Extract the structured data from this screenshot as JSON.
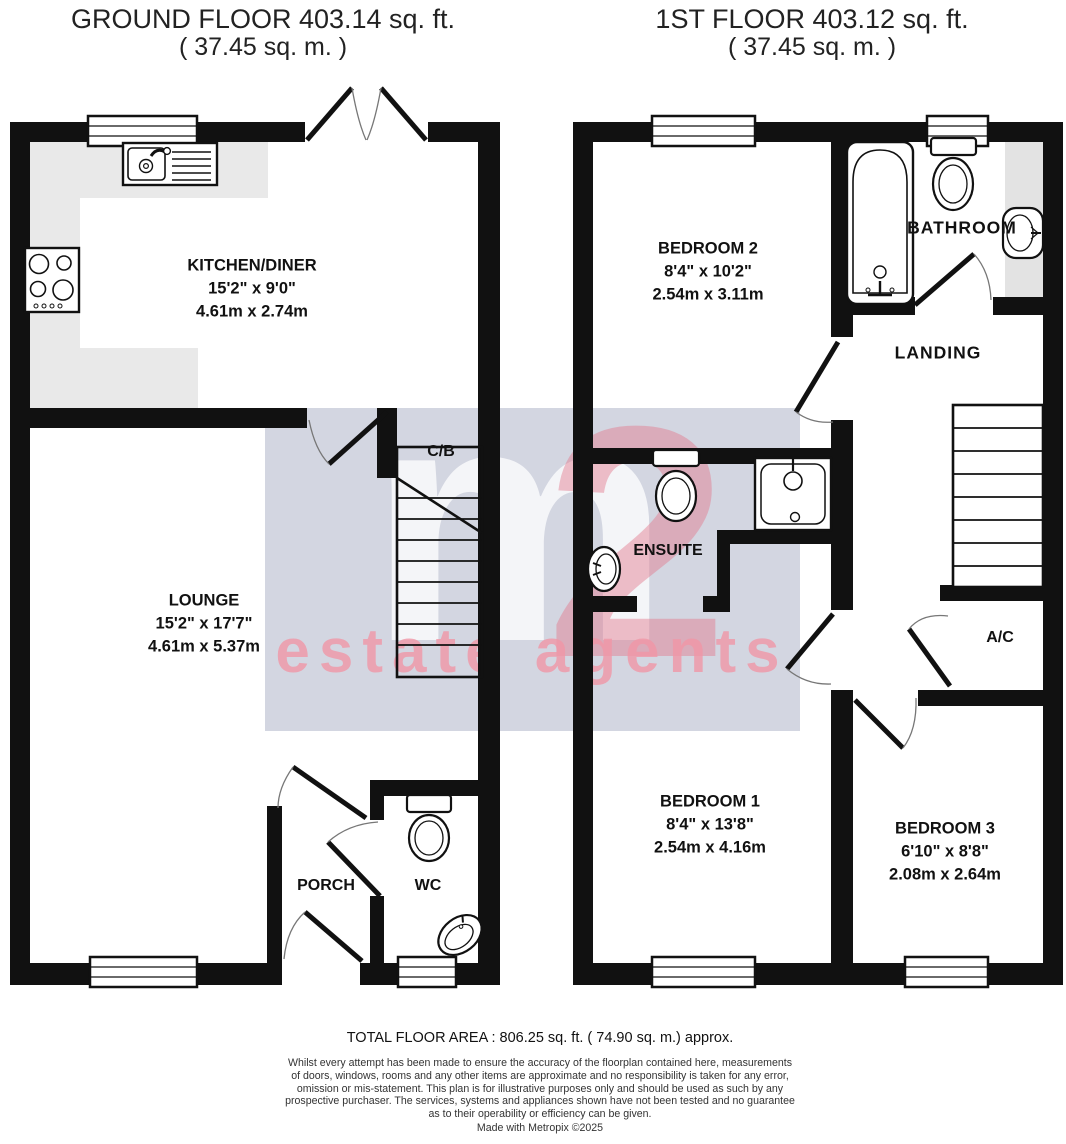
{
  "ground_floor": {
    "title": "GROUND FLOOR 403.14 sq. ft.",
    "subtitle": "( 37.45 sq. m. )",
    "rooms": {
      "kitchen": {
        "name": "KITCHEN/DINER",
        "imperial": "15'2\" x 9'0\"",
        "metric": "4.61m x 2.74m"
      },
      "lounge": {
        "name": "LOUNGE",
        "imperial": "15'2\" x 17'7\"",
        "metric": "4.61m x 5.37m"
      },
      "cb": {
        "name": "C/B"
      },
      "porch": {
        "name": "PORCH"
      },
      "wc": {
        "name": "WC"
      }
    }
  },
  "first_floor": {
    "title": "1ST FLOOR 403.12 sq. ft.",
    "subtitle": "( 37.45 sq. m. )",
    "rooms": {
      "bedroom2": {
        "name": "BEDROOM 2",
        "imperial": "8'4\" x 10'2\"",
        "metric": "2.54m x 3.11m"
      },
      "bathroom": {
        "name": "BATHROOM"
      },
      "landing": {
        "name": "LANDING"
      },
      "ensuite": {
        "name": "ENSUITE"
      },
      "ac": {
        "name": "A/C"
      },
      "bedroom1": {
        "name": "BEDROOM 1",
        "imperial": "8'4\" x 13'8\"",
        "metric": "2.54m x 4.16m"
      },
      "bedroom3": {
        "name": "BEDROOM 3",
        "imperial": "6'10\" x 8'8\"",
        "metric": "2.08m x 2.64m"
      }
    }
  },
  "watermark": {
    "m": "m",
    "two": "2",
    "tagline": "estate agents"
  },
  "footer": {
    "total_area": "TOTAL FLOOR AREA : 806.25 sq. ft. ( 74.90 sq. m.) approx.",
    "disclaimer": "Whilst every attempt has been made to ensure the accuracy of the floorplan contained here, measurements\nof doors, windows, rooms and any other items are approximate and no responsibility is taken for any error,\nomission or mis-statement. This plan is for illustrative purposes only and should be used as such by any\nprospective purchaser. The services, systems and appliances shown have not been tested and no guarantee\nas to their operability or efficiency can be given.",
    "credit": "Made with Metropix ©2025"
  },
  "colors": {
    "wall": "#111111",
    "counter": "#e9e9e9",
    "tile": "#e3e3e3",
    "watermark_bg": "#d3d6e1",
    "watermark_pink": "#ef9bac",
    "watermark_white": "#f2f3f7"
  }
}
